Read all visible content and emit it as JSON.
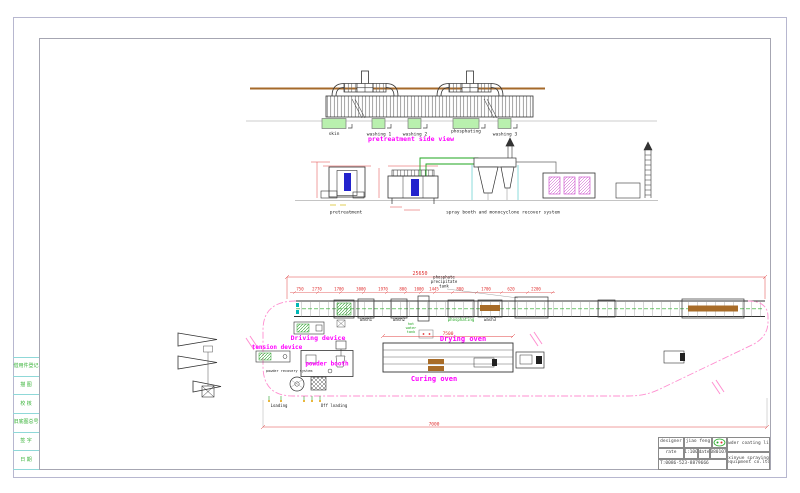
{
  "drawing": {
    "top_view": {
      "title": "pretreatment side view",
      "tank_labels": [
        "skin",
        "washing 1",
        "washing 2",
        "phosphating",
        "washing 3"
      ]
    },
    "section_view": {
      "left_label": "pretreatment",
      "right_label": "spray booth and monocyclone recover system"
    },
    "plan_view": {
      "driving_device": "Driving device",
      "tension_device": "tension device",
      "powder_booth": "powder booth",
      "powder_recovery_system": "powder recovery system",
      "drying_oven": "Drying oven",
      "curing_oven": "Curing oven",
      "loading": "Loading",
      "off_loading": "Off loading",
      "wash1": "wash1",
      "wash2": "wash2",
      "wash3": "wash3",
      "phosphating": "phosphating",
      "hot_water_tank": [
        "hot",
        "water",
        "tank"
      ],
      "phosphate_note": [
        "phosphate",
        "precipitate",
        "tank"
      ],
      "dim_overall": "25650",
      "dim_oven": "7500",
      "dim_bottom": "7000",
      "dims_row": [
        "750",
        "2770",
        "1700",
        "3000",
        "1970",
        "800",
        "1000",
        "1445",
        "880",
        "1700",
        "620",
        "2200"
      ]
    }
  },
  "margin_strip": {
    "cells": [
      "借用件登记",
      "描 图",
      "校 核",
      "旧底图总号",
      "签 字",
      "日 期"
    ]
  },
  "title_block": {
    "designer_label": "designer",
    "designer_value": "jiao feng",
    "scale_label": "rate",
    "scale_value": "1:100",
    "date_label": "date",
    "date_value": "080107",
    "phone": "T:0086-523-8879666",
    "product": "powder coating line",
    "company_line1": "xinyue spraying",
    "company_line2": "equipment co.ltd"
  },
  "colors": {
    "magenta_label": "#ff00ff",
    "dimension_red": "#e03030",
    "tank_green_fill": "#b9f0ae",
    "green_text": "#1fa51f",
    "monorail_brown": "#a5692a",
    "path_pink": "#ff8fd0",
    "part_blue": "#2323cd",
    "border_gray": "#b7b7cf"
  }
}
